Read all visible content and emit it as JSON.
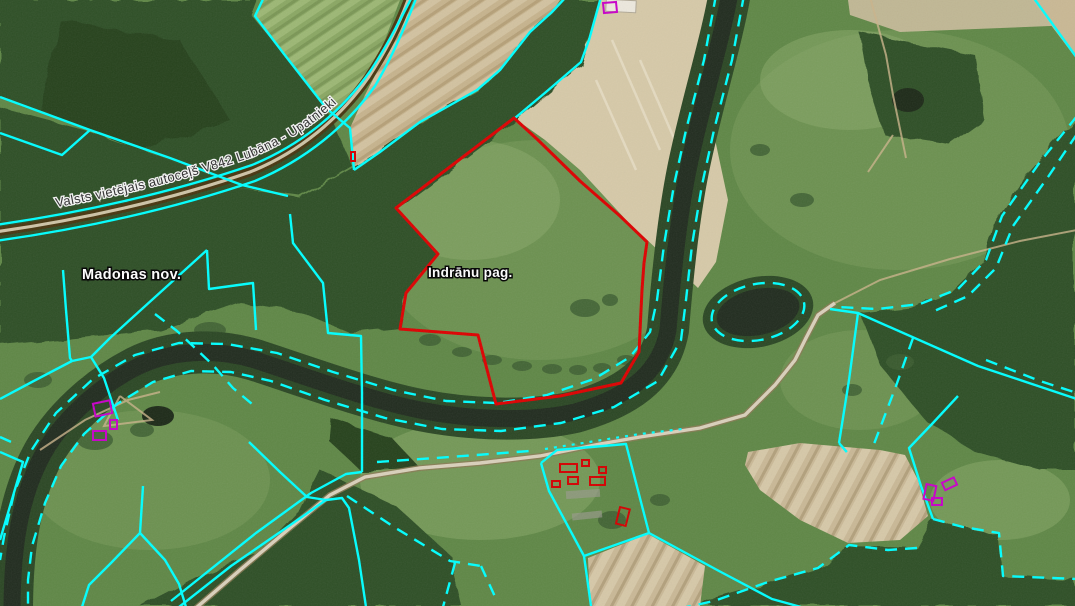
{
  "map_view": {
    "kind": "cadastral-orthophoto-map",
    "labels": {
      "municipality": "Madonas nov.",
      "parish": "Indrānu pag.",
      "road": "Valsts vietējais autoceļš V842 Lubāna - Upatnieki"
    },
    "colors": {
      "parcel_boundary_cyan": "#00ffff",
      "selected_parcel_red": "#dd0000",
      "building_outline_magenta": "#c800c8",
      "building_outline_red": "#d40000",
      "water": "#212c1f",
      "forest": "#2f4f28",
      "meadow": "#5f8746",
      "field_tan": "#c6b38d",
      "field_sand": "#d6c9a8",
      "road_surface": "#cdc3a6",
      "road_casing": "#473610"
    }
  }
}
